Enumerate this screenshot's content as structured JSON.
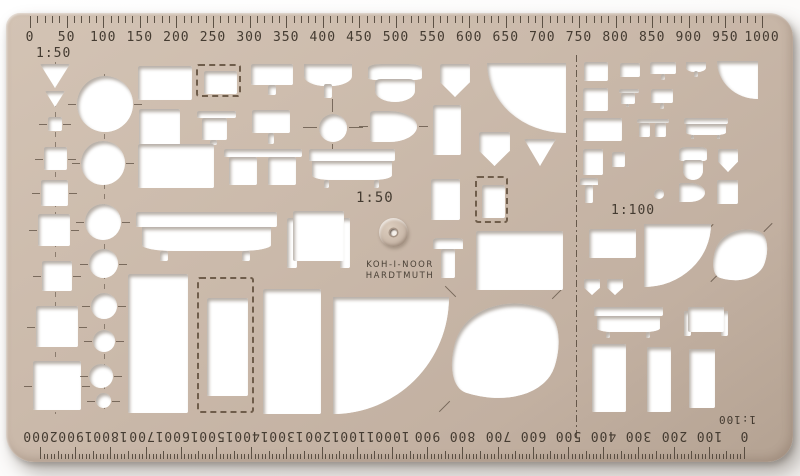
{
  "brand": {
    "line1": "KOH-I-NOOR",
    "line2": "HARDTMUTH"
  },
  "labels": {
    "scale_top_left": "1:50",
    "scale_center": "1:50",
    "scale_right": "1:100",
    "scale_bottom": "1:100"
  },
  "colors": {
    "template_beige": "#cbbaab",
    "template_shade": "#b4a292",
    "engraving": "#4a4036",
    "cutout_white": "#ffffff",
    "photo_background": "#ffffff"
  },
  "top_ruler": {
    "labels": [
      "0",
      "50",
      "100",
      "150",
      "200",
      "250",
      "300",
      "350",
      "400",
      "450",
      "500",
      "550",
      "600",
      "650",
      "700",
      "750",
      "800",
      "850",
      "900",
      "950",
      "1000"
    ]
  },
  "bottom_ruler": {
    "labels": [
      "2000",
      "1900",
      "1800",
      "1700",
      "1600",
      "1500",
      "1400",
      "1300",
      "1200",
      "1100",
      "1000",
      "900",
      "800",
      "700",
      "600",
      "500",
      "400",
      "300",
      "200",
      "100",
      "0"
    ]
  },
  "cutouts": [
    {
      "n": "triangle-cutout-large",
      "s": "tri-down",
      "x": 40,
      "y": 64,
      "w": 30,
      "h": 24
    },
    {
      "n": "triangle-cutout-small",
      "s": "tri-down",
      "x": 45,
      "y": 91,
      "w": 20,
      "h": 16
    },
    {
      "n": "square-cutout-1",
      "s": "rect",
      "x": 48,
      "y": 117,
      "w": 14,
      "h": 14,
      "t": 1
    },
    {
      "n": "square-cutout-2",
      "s": "rect",
      "x": 44,
      "y": 147,
      "w": 23,
      "h": 23,
      "t": 1
    },
    {
      "n": "square-cutout-3",
      "s": "rect",
      "x": 41,
      "y": 180,
      "w": 27,
      "h": 26,
      "t": 1
    },
    {
      "n": "square-cutout-4",
      "s": "rect",
      "x": 38,
      "y": 214,
      "w": 32,
      "h": 32,
      "t": 1
    },
    {
      "n": "square-cutout-5",
      "s": "rect",
      "x": 42,
      "y": 261,
      "w": 30,
      "h": 30,
      "t": 1
    },
    {
      "n": "square-cutout-6",
      "s": "rect",
      "x": 36,
      "y": 306,
      "w": 42,
      "h": 41,
      "t": 1
    },
    {
      "n": "square-cutout-7",
      "s": "rect",
      "x": 33,
      "y": 361,
      "w": 48,
      "h": 49,
      "t": 1
    },
    {
      "n": "circle-cutout-1",
      "s": "circle",
      "x": 77,
      "y": 76,
      "w": 56,
      "h": 56,
      "t": 1
    },
    {
      "n": "circle-cutout-2",
      "s": "circle",
      "x": 81,
      "y": 141,
      "w": 44,
      "h": 44,
      "t": 1
    },
    {
      "n": "circle-cutout-3",
      "s": "circle",
      "x": 85,
      "y": 204,
      "w": 36,
      "h": 36,
      "t": 1
    },
    {
      "n": "circle-cutout-4",
      "s": "circle",
      "x": 89,
      "y": 249,
      "w": 29,
      "h": 29,
      "t": 1
    },
    {
      "n": "circle-cutout-5",
      "s": "circle",
      "x": 91,
      "y": 293,
      "w": 26,
      "h": 26,
      "t": 1
    },
    {
      "n": "circle-cutout-6",
      "s": "circle",
      "x": 93,
      "y": 330,
      "w": 22,
      "h": 22,
      "t": 1
    },
    {
      "n": "circle-cutout-7",
      "s": "circle",
      "x": 89,
      "y": 364,
      "w": 24,
      "h": 24,
      "t": 1
    },
    {
      "n": "circle-cutout-8",
      "s": "circle",
      "x": 96,
      "y": 393,
      "w": 15,
      "h": 15,
      "t": 1
    },
    {
      "n": "bed-cutout",
      "s": "rect",
      "x": 138,
      "y": 66,
      "w": 54,
      "h": 34
    },
    {
      "n": "dashed-rect-cutout",
      "s": "dashed-rect",
      "x": 196,
      "y": 64,
      "w": 45,
      "h": 33
    },
    {
      "n": "washbasin-cutout",
      "s": "basin",
      "x": 251,
      "y": 64,
      "w": 42,
      "h": 31
    },
    {
      "n": "round-washbasin-cutout",
      "s": "basin-round",
      "x": 304,
      "y": 64,
      "w": 48,
      "h": 34
    },
    {
      "n": "toilet-cutout",
      "s": "toilet",
      "x": 368,
      "y": 64,
      "w": 54,
      "h": 38
    },
    {
      "n": "urinal-cutout",
      "s": "pent-down",
      "x": 440,
      "y": 64,
      "w": 30,
      "h": 33
    },
    {
      "n": "quarter-circle-cutout-large",
      "s": "quarter-bl",
      "x": 487,
      "y": 63,
      "w": 79,
      "h": 70
    },
    {
      "n": "table-rect-cutout",
      "s": "rect",
      "x": 139,
      "y": 109,
      "w": 41,
      "h": 36
    },
    {
      "n": "table-cutout",
      "s": "table",
      "x": 197,
      "y": 111,
      "w": 39,
      "h": 34
    },
    {
      "n": "washbasin-cutout-2",
      "s": "basin",
      "x": 252,
      "y": 110,
      "w": 38,
      "h": 34
    },
    {
      "n": "crosshair-circle-cutout",
      "s": "circle",
      "x": 319,
      "y": 114,
      "w": 28,
      "h": 28
    },
    {
      "n": "bidet-cutout",
      "s": "bidet",
      "x": 370,
      "y": 111,
      "w": 47,
      "h": 31
    },
    {
      "n": "cabinet-cutout",
      "s": "rect",
      "x": 433,
      "y": 105,
      "w": 28,
      "h": 50
    },
    {
      "n": "double-bed-cutout",
      "s": "rect",
      "x": 138,
      "y": 144,
      "w": 76,
      "h": 44
    },
    {
      "n": "double-table-cutout",
      "s": "double-table",
      "x": 224,
      "y": 149,
      "w": 78,
      "h": 38
    },
    {
      "n": "bathtub-cutout",
      "s": "bathtub",
      "x": 309,
      "y": 149,
      "w": 86,
      "h": 39
    },
    {
      "n": "shower-cutout",
      "s": "pent-down",
      "x": 479,
      "y": 132,
      "w": 31,
      "h": 34
    },
    {
      "n": "triangle-cutout-mid",
      "s": "tri-down",
      "x": 524,
      "y": 139,
      "w": 32,
      "h": 27
    },
    {
      "n": "cabinet-cutout-2",
      "s": "rect",
      "x": 431,
      "y": 179,
      "w": 29,
      "h": 41
    },
    {
      "n": "dashed-rect-cutout-2",
      "s": "dashed-rect",
      "x": 475,
      "y": 176,
      "w": 33,
      "h": 47
    },
    {
      "n": "bed-cutout-2",
      "s": "rect",
      "x": 476,
      "y": 231,
      "w": 87,
      "h": 59
    },
    {
      "n": "chair-cutout",
      "s": "chair",
      "x": 433,
      "y": 238,
      "w": 30,
      "h": 40
    },
    {
      "n": "bathtub-cutout-large",
      "s": "bathtub",
      "x": 136,
      "y": 212,
      "w": 141,
      "h": 49
    },
    {
      "n": "armchair-cutout",
      "s": "armchair",
      "x": 287,
      "y": 211,
      "w": 63,
      "h": 61
    },
    {
      "n": "wardrobe-cutout-1",
      "s": "rect",
      "x": 128,
      "y": 274,
      "w": 60,
      "h": 139
    },
    {
      "n": "dashed-wardrobe-cutout",
      "s": "dashed-rect",
      "x": 197,
      "y": 277,
      "w": 57,
      "h": 136
    },
    {
      "n": "wardrobe-cutout-2",
      "s": "rect",
      "x": 263,
      "y": 289,
      "w": 58,
      "h": 125
    },
    {
      "n": "quarter-piano-cutout",
      "s": "quarter-br",
      "x": 333,
      "y": 297,
      "w": 116,
      "h": 117
    },
    {
      "n": "grand-piano-cutout",
      "s": "blob",
      "x": 455,
      "y": 299,
      "w": 102,
      "h": 104
    },
    {
      "n": "s100-bed-cutout",
      "s": "rect",
      "x": 584,
      "y": 62,
      "w": 24,
      "h": 19
    },
    {
      "n": "s100-rect-small-cutout",
      "s": "rect",
      "x": 620,
      "y": 63,
      "w": 20,
      "h": 14
    },
    {
      "n": "s100-washbasin-cutout",
      "s": "basin",
      "x": 650,
      "y": 62,
      "w": 26,
      "h": 18
    },
    {
      "n": "s100-round-washbasin-cutout",
      "s": "basin-round",
      "x": 686,
      "y": 62,
      "w": 20,
      "h": 15
    },
    {
      "n": "s100-quarter-circle-cutout",
      "s": "quarter-bl",
      "x": 717,
      "y": 61,
      "w": 41,
      "h": 38
    },
    {
      "n": "s100-rect-cutout-2",
      "s": "rect",
      "x": 583,
      "y": 88,
      "w": 25,
      "h": 23
    },
    {
      "n": "s100-table-cutout",
      "s": "table",
      "x": 619,
      "y": 89,
      "w": 20,
      "h": 18
    },
    {
      "n": "s100-washbasin-cutout-2",
      "s": "basin",
      "x": 651,
      "y": 89,
      "w": 22,
      "h": 20
    },
    {
      "n": "s100-double-bed-cutout",
      "s": "rect",
      "x": 583,
      "y": 118,
      "w": 39,
      "h": 23
    },
    {
      "n": "s100-double-table-cutout",
      "s": "double-table",
      "x": 637,
      "y": 119,
      "w": 32,
      "h": 19
    },
    {
      "n": "s100-bathtub-cutout",
      "s": "bathtub",
      "x": 684,
      "y": 118,
      "w": 44,
      "h": 21
    },
    {
      "n": "s100-cabinet-cutout",
      "s": "rect",
      "x": 583,
      "y": 149,
      "w": 20,
      "h": 26
    },
    {
      "n": "s100-square-cutout",
      "s": "rect",
      "x": 612,
      "y": 152,
      "w": 13,
      "h": 15
    },
    {
      "n": "s100-toilet-cutout",
      "s": "toilet",
      "x": 679,
      "y": 147,
      "w": 28,
      "h": 33
    },
    {
      "n": "s100-urinal-cutout",
      "s": "pent-down",
      "x": 718,
      "y": 149,
      "w": 20,
      "h": 23
    },
    {
      "n": "s100-chair-cutout",
      "s": "chair",
      "x": 580,
      "y": 178,
      "w": 18,
      "h": 25
    },
    {
      "n": "s100-circle-cutout",
      "s": "circle",
      "x": 654,
      "y": 189,
      "w": 10,
      "h": 10
    },
    {
      "n": "s100-bidet-cutout",
      "s": "bidet",
      "x": 679,
      "y": 183,
      "w": 26,
      "h": 19
    },
    {
      "n": "s100-rect-cutout-3",
      "s": "rect",
      "x": 717,
      "y": 180,
      "w": 21,
      "h": 24
    },
    {
      "n": "s100-sofa-cutout",
      "s": "rect",
      "x": 589,
      "y": 229,
      "w": 47,
      "h": 29
    },
    {
      "n": "s100-quarter-piano-cutout",
      "s": "quarter-br",
      "x": 644,
      "y": 224,
      "w": 67,
      "h": 63
    },
    {
      "n": "s100-grand-piano-cutout",
      "s": "blob",
      "x": 715,
      "y": 227,
      "w": 51,
      "h": 56
    },
    {
      "n": "s100-pent-cutout-1",
      "s": "pent-down",
      "x": 584,
      "y": 279,
      "w": 16,
      "h": 16
    },
    {
      "n": "s100-pent-cutout-2",
      "s": "pent-down",
      "x": 607,
      "y": 279,
      "w": 16,
      "h": 16
    },
    {
      "n": "s100-bathtub-cutout-2",
      "s": "bathtub",
      "x": 594,
      "y": 307,
      "w": 69,
      "h": 31
    },
    {
      "n": "s100-armchair-cutout",
      "s": "armchair",
      "x": 684,
      "y": 307,
      "w": 44,
      "h": 31
    },
    {
      "n": "s100-wardrobe-cutout-1",
      "s": "rect",
      "x": 592,
      "y": 344,
      "w": 34,
      "h": 68
    },
    {
      "n": "s100-wardrobe-cutout-2",
      "s": "rect",
      "x": 647,
      "y": 347,
      "w": 24,
      "h": 65
    },
    {
      "n": "s100-wardrobe-cutout-3",
      "s": "rect",
      "x": 689,
      "y": 349,
      "w": 26,
      "h": 59
    }
  ],
  "guide_lines": [
    {
      "n": "section-divider-line",
      "k": "dashdot",
      "x": 576,
      "y": 55,
      "w": 1,
      "h": 385
    },
    {
      "n": "axis-line-squares",
      "k": "dashedv",
      "x": 55,
      "y": 62,
      "w": 1,
      "h": 352
    },
    {
      "n": "axis-line-circles",
      "k": "dashedv",
      "x": 104,
      "y": 74,
      "w": 1,
      "h": 336
    },
    {
      "n": "crosshair-left",
      "k": "solid",
      "x": 303,
      "y": 127,
      "w": 14,
      "h": 1
    },
    {
      "n": "crosshair-right",
      "k": "solid",
      "x": 349,
      "y": 127,
      "w": 14,
      "h": 1
    },
    {
      "n": "crosshair-top",
      "k": "solid",
      "x": 332,
      "y": 99,
      "w": 1,
      "h": 13
    },
    {
      "n": "crosshair-bottom",
      "k": "solid",
      "x": 332,
      "y": 144,
      "w": 1,
      "h": 13
    },
    {
      "n": "bidet-tick-left",
      "k": "solid",
      "x": 359,
      "y": 126,
      "w": 9,
      "h": 1
    },
    {
      "n": "bidet-tick-right",
      "k": "solid",
      "x": 419,
      "y": 126,
      "w": 9,
      "h": 1
    },
    {
      "n": "piano-tick-1",
      "k": "solid",
      "x": 443,
      "y": 291,
      "w": 15,
      "h": 1,
      "r": 45
    },
    {
      "n": "piano-tick-2",
      "k": "solid",
      "x": 550,
      "y": 293,
      "w": 15,
      "h": 1,
      "r": -45
    },
    {
      "n": "piano-tick-3",
      "k": "solid",
      "x": 437,
      "y": 406,
      "w": 15,
      "h": 1,
      "r": -45
    },
    {
      "n": "s100-piano-tick-1",
      "k": "solid",
      "x": 703,
      "y": 228,
      "w": 12,
      "h": 1,
      "r": -45
    },
    {
      "n": "s100-piano-tick-2",
      "k": "solid",
      "x": 762,
      "y": 227,
      "w": 12,
      "h": 1,
      "r": -45
    },
    {
      "n": "s100-piano-tick-3",
      "k": "solid",
      "x": 709,
      "y": 277,
      "w": 12,
      "h": 1,
      "r": -45
    }
  ]
}
